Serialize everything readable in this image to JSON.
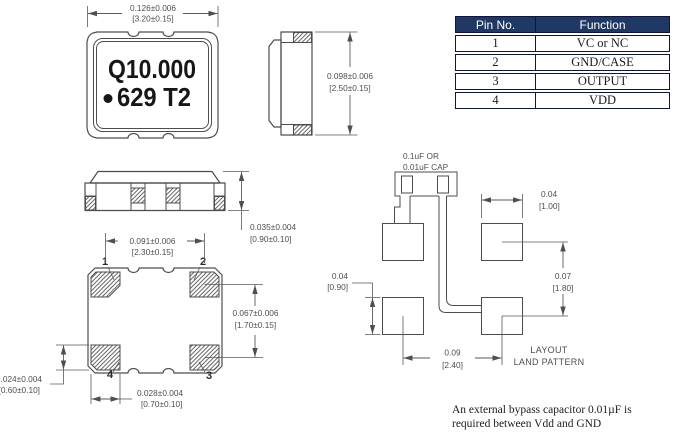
{
  "drawing": {
    "marking": {
      "line1": "Q10.000",
      "line2": "629 T2"
    },
    "dims": {
      "body_width": {
        "inch": "0.126±0.006",
        "mm": "[3.20±0.15]"
      },
      "body_height": {
        "inch": "0.098±0.006",
        "mm": "[2.50±0.15]"
      },
      "base_height": {
        "inch": "0.035±0.004",
        "mm": "[0.90±0.10]"
      },
      "pad_pitch_x": {
        "inch": "0.091±0.006",
        "mm": "[2.30±0.15]"
      },
      "pad_pitch_y": {
        "inch": "0.067±0.006",
        "mm": "[1.70±0.15]"
      },
      "pad_width": {
        "inch": "0.028±0.004",
        "mm": "[0.70±0.10]"
      },
      "pad_height": {
        "inch": "0.024±0.004",
        "mm": "[0.60±0.10]"
      }
    },
    "pins": {
      "p1": "1",
      "p2": "2",
      "p3": "3",
      "p4": "4"
    }
  },
  "land_pattern": {
    "cap_label": {
      "line1": "0.1uF OR",
      "line2": "0.01uF CAP"
    },
    "dims": {
      "pad_w": {
        "inch": "0.04",
        "mm": "[1.00]"
      },
      "pitch_y": {
        "inch": "0.07",
        "mm": "[1.80]"
      },
      "pad_h": {
        "inch": "0.04",
        "mm": "[0.90]"
      },
      "pitch_x": {
        "inch": "0.09",
        "mm": "[2.40]"
      }
    },
    "title": {
      "line1": "LAYOUT",
      "line2": "LAND PATTERN"
    }
  },
  "pin_table": {
    "headers": [
      "Pin No.",
      "Function"
    ],
    "rows": [
      [
        "1",
        "VC or NC"
      ],
      [
        "2",
        "GND/CASE"
      ],
      [
        "3",
        "OUTPUT"
      ],
      [
        "4",
        "VDD"
      ]
    ]
  },
  "note": {
    "line1": "An external bypass capacitor 0.01µF is",
    "line2": "required between Vdd and GND"
  },
  "colors": {
    "line": "#4d4d4d",
    "dim_text": "#4f4f4f",
    "table_header_bg": "#1f3864"
  }
}
